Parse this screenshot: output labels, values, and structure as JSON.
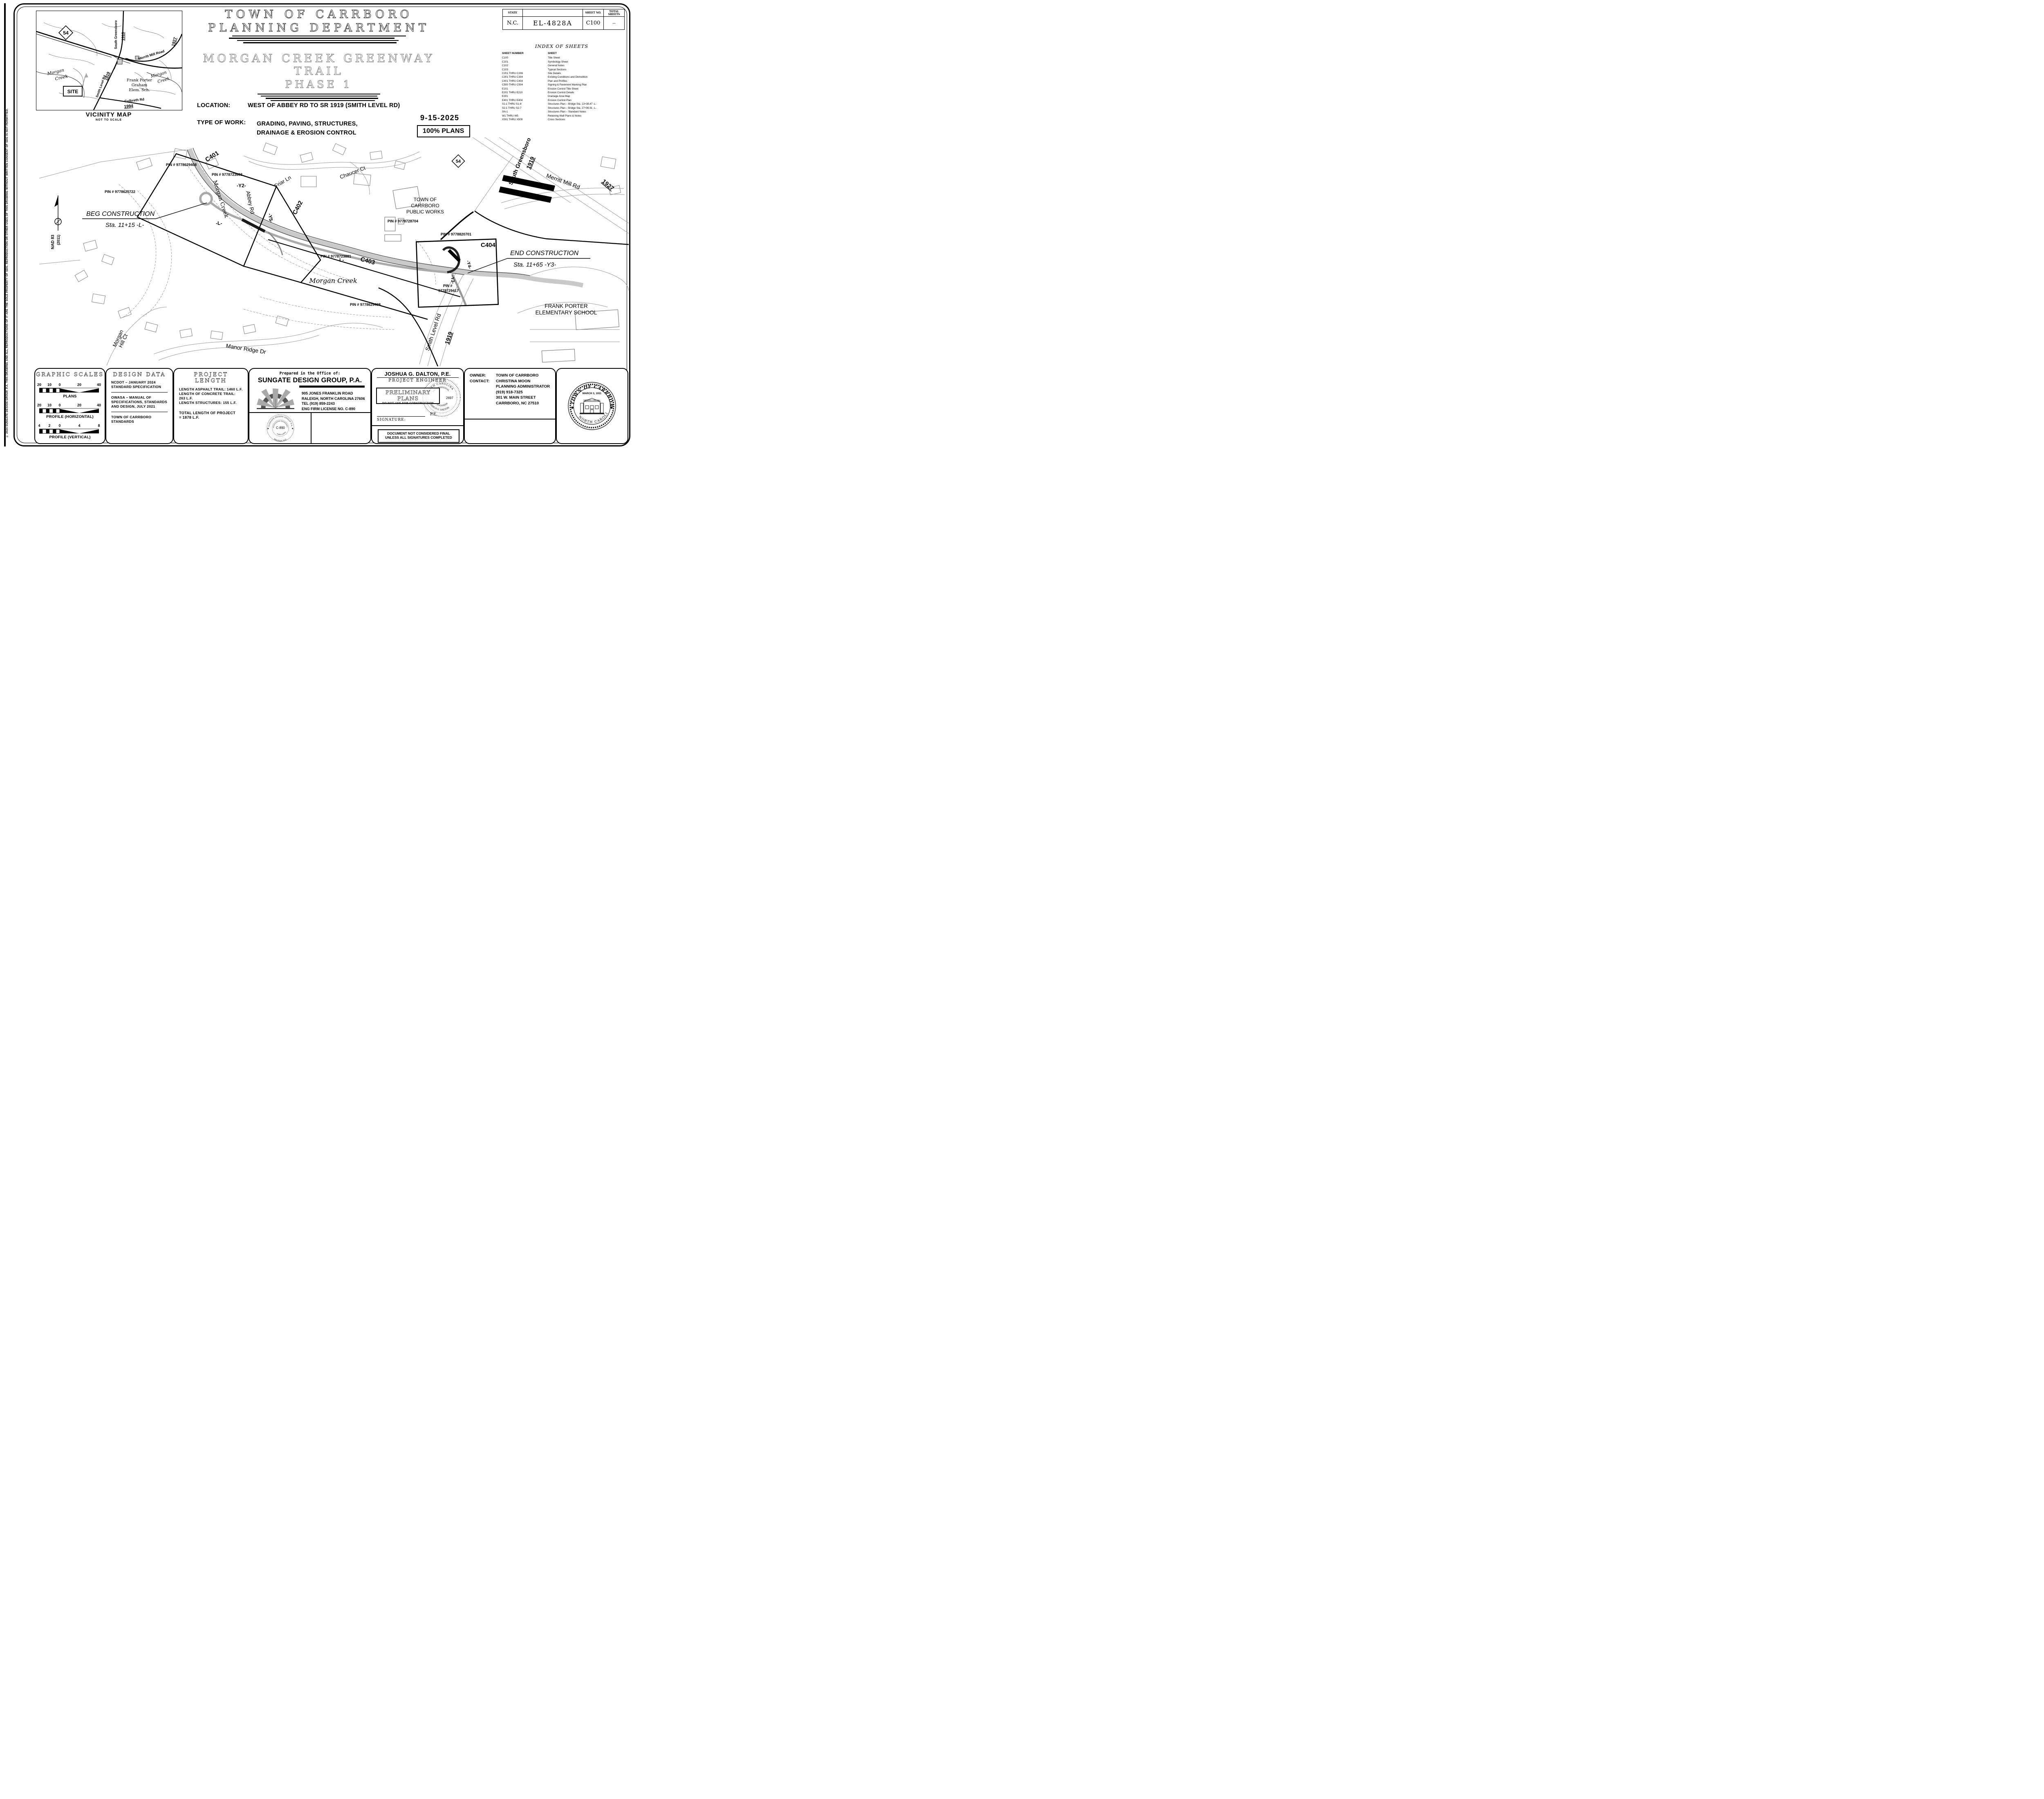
{
  "sidebar": {
    "copyright": "© 2024 SUNGATE DESIGN GROUP, P.A.   THIS DRAWING AND ALL REPRODUCTIONS OF IT ARE THE SOLE PROPERTY OF SDG. REPRODUCTION OR OTHER USES OF THIS DRAWING WITHOUT WRITTEN CONSENT OF SDG IS NOT PERMITTED."
  },
  "title_block": {
    "state_label": "STATE",
    "state": "N.C.",
    "project_no": "EL-4828A",
    "sheet_no_label": "SHEET NO.",
    "sheet_no": "C100",
    "total_label": "TOTAL SHEETS",
    "total": "--"
  },
  "header": {
    "agency_line1": "TOWN OF CARRBORO",
    "agency_line2": "PLANNING DEPARTMENT",
    "project_line1": "MORGAN CREEK GREENWAY TRAIL",
    "project_line2": "PHASE 1",
    "location_label": "LOCATION:",
    "location": "WEST OF ABBEY RD TO SR 1919 (SMITH LEVEL RD)",
    "work_label": "TYPE OF WORK:",
    "work_line1": "GRADING, PAVING, STRUCTURES,",
    "work_line2": "DRAINAGE & EROSION CONTROL",
    "date": "9-15-2025",
    "plans_status": "100% PLANS"
  },
  "index": {
    "title": "INDEX OF SHEETS",
    "col_number": "SHEET NUMBER",
    "col_sheet": "SHEET",
    "rows": [
      {
        "num": "C100",
        "name": "Title Sheet"
      },
      {
        "num": "C101",
        "name": "Symbology Sheet"
      },
      {
        "num": "C102",
        "name": "General Notes"
      },
      {
        "num": "C103",
        "name": "Typical Sections"
      },
      {
        "num": "C201 THRU C206",
        "name": "Site Details"
      },
      {
        "num": "C301 THRU C304",
        "name": "Existing Conditions and Demolition"
      },
      {
        "num": "C401 THRU C404",
        "name": "Plan and Profiles"
      },
      {
        "num": "C500 THRU C504",
        "name": "Signing & Pavement Marking Plan"
      },
      {
        "num": "E101",
        "name": "Erosion Control Title Sheet"
      },
      {
        "num": "E201 THRU E210",
        "name": "Erosion Control Details"
      },
      {
        "num": "E301",
        "name": "Drainage Area Map"
      },
      {
        "num": "E401 THRU E404",
        "name": "Erosion Control Plan"
      },
      {
        "num": "S1-1 THRU S1-8",
        "name": "Structures Plan – Bridge Sta. 13+38.47 -L-"
      },
      {
        "num": "S2-1 THRU S2-7",
        "name": "Structures Plan – Bridge Sta. 27+06.91 -L-"
      },
      {
        "num": "SN-1",
        "name": "Structures Plan – Standard Notes"
      },
      {
        "num": "W1 THRU W5",
        "name": "Retaining Wall Plans & Notes"
      },
      {
        "num": "X501 THRU X509",
        "name": "Cross Sections"
      }
    ]
  },
  "vicinity": {
    "caption": "VICINITY MAP",
    "subcaption": "NOT TO SCALE",
    "labels": {
      "route54": "54",
      "south_greensboro": "South Greensboro",
      "sg_route": "1919",
      "merritt": "Merritt Mill Road",
      "merritt_route": "1927",
      "morgan_creek_1a": "Morgan",
      "morgan_creek_1b": "Creek",
      "site": "SITE",
      "smith_level": "Smith Level Rd",
      "sl_route": "1919",
      "school_1": "Frank Porter",
      "school_2": "Graham",
      "school_3": "Elem. Sch.",
      "morgan_creek_2a": "Morgan",
      "morgan_creek_2b": "Creek",
      "culbreth": "Culbreth Rd",
      "culbreth_route": "1994"
    }
  },
  "plan": {
    "labels": {
      "c401": "C401",
      "c402": "C402",
      "c403": "C403",
      "c404": "C404",
      "pin_top": "PIN # 9778629408",
      "pin_723603": "PIN # 9778723603",
      "pin_625722": "PIN # 9778625722",
      "pin_723881": "PIN # 9778723881",
      "pin_728704": "PIN # 9778728704",
      "pin_820701": "PIN # 9778820701",
      "pin_729417_a": "PIN #",
      "pin_729417_b": "9778729417",
      "pin_bottom": "PIN # 9778629408",
      "morgan_creek_upper": "Morgan Creek",
      "morgan_creek_center": "Morgan Creek",
      "abbey_rd": "Abbey Rd",
      "y2": "-Y2-",
      "y5": "-Y5-",
      "y3": "-Y3-",
      "y4": "-Y4-",
      "l_upper": "-L-",
      "l_center": "-L-",
      "friar_ln": "Friar Ln",
      "chaucer_ct": "Chaucer Ct",
      "beg_construction": "BEG CONSTRUCTION",
      "beg_sta": "Sta. 11+15  -L-",
      "end_construction": "END CONSTRUCTION",
      "end_sta": "Sta. 11+65  -Y3-",
      "public_works_1": "TOWN OF",
      "public_works_2": "CARRBORO",
      "public_works_3": "PUBLIC WORKS",
      "school_1": "FRANK PORTER",
      "school_2": "ELEMENTARY SCHOOL",
      "smith_level_rd": "Smith Level Rd",
      "smith_route": "1919",
      "manor_ridge": "Manor Ridge Dr",
      "morgan_hill_1": "Morgan",
      "morgan_hill_2": "Hill Ct",
      "route54": "54",
      "s_greensboro": "South Greensboro St",
      "sg_route": "1919",
      "merritt": "Merritt Mill Rd",
      "merritt_route": "1927",
      "nad_1": "NAD 83",
      "nad_2": "(2011)"
    }
  },
  "scales": {
    "title": "GRAPHIC SCALES",
    "bars": [
      {
        "ticks": [
          "20",
          "10",
          "0",
          "20",
          "40"
        ],
        "label": "PLANS"
      },
      {
        "ticks": [
          "20",
          "10",
          "0",
          "20",
          "40"
        ],
        "label": "PROFILE (HORIZONTAL)"
      },
      {
        "ticks": [
          "4",
          "2",
          "0",
          "4",
          "8"
        ],
        "label": "PROFILE (VERTICAL)"
      }
    ]
  },
  "design_data": {
    "title": "DESIGN DATA",
    "item1": "NCDOT – JANUARY 2024 STANDARD SPECIFICATION",
    "item2": "OWASA – MANUAL OF SPECIFICATIONS, STANDARDS AND DESIGN, JULY 2021",
    "item3": "TOWN OF CARRBORO STANDARDS"
  },
  "project_length": {
    "title": "PROJECT LENGTH",
    "line1": "LENGTH ASPHALT TRAIL: 1460 L.F.",
    "line2": "LENGTH OF CONCRETE TRAIL: 263 L.F.",
    "line3": "LENGTH STRUCTURES: 155 L.F.",
    "total_1": "TOTAL LENGTH OF PROJECT",
    "total_2": "=  1878 L.F."
  },
  "firm": {
    "prepared": "Prepared in the Office of:",
    "name": "SUNGATE DESIGN GROUP, P.A.",
    "address1": "905 JONES FRANKLIN ROAD",
    "address2": "RALEIGH, NORTH CAROLINA 27606",
    "address3": "TEL (919) 859-2243",
    "address4": "ENG FIRM LICENSE NO. C-890",
    "seal_top": "SUNGATE DESIGN GROUP P.A.",
    "seal_mid": "PROFESSIONAL ENGINEERING CORPORATION",
    "seal_center": "C-890",
    "seal_inner_bottom": "NORTH CAROLINA",
    "seal_bottom": "RALEIGH, N.C.",
    "seal_star_left": "★",
    "seal_star_right": "★"
  },
  "engineer": {
    "name": "JOSHUA G. DALTON,  P.E.",
    "role": "PROJECT ENGINEER",
    "prelim_1": "PRELIMINARY PLANS",
    "prelim_2": "DO NOT USE FOR CONSTRUCTION",
    "pe": "P.E.",
    "signature_label": "SIGNATURE:",
    "final_1": "DOCUMENT NOT CONSIDERED FINAL",
    "final_2": "UNLESS ALL SIGNATURES COMPLETED",
    "seal_top": "NORTH CAROLINA",
    "seal_inner": "PROFESSIONAL",
    "seal_num": "2697",
    "seal_eng": "ENGINEER",
    "seal_name": "JOSHUA G. DALTON"
  },
  "owner": {
    "owner_label": "OWNER:",
    "owner": "TOWN OF CARRBORO",
    "contact_label": "CONTACT:",
    "contact": "CHRISTINA MOON",
    "role": "PLANNING ADMINISTRATOR",
    "phone": "(919) 918-7325",
    "street": "301 W. MAIN STREET",
    "city": "CARRBORO, NC  27510"
  },
  "town_seal": {
    "top": "TOWN OF CARRBORO",
    "bottom": "NORTH CAROLINA",
    "date": "MARCH 3, 1911",
    "hall": "CARRBORO TOWN HALL"
  }
}
